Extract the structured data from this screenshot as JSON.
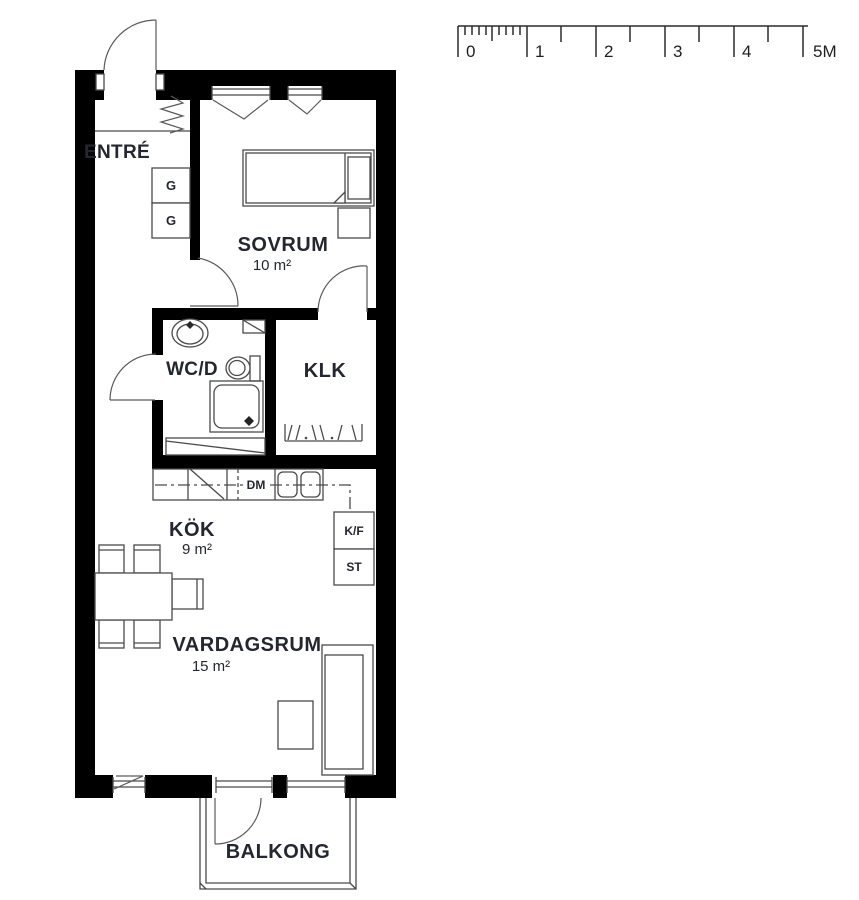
{
  "scale_bar": {
    "labels": [
      "0",
      "1",
      "2",
      "3",
      "4",
      "5M"
    ]
  },
  "rooms": {
    "entre": {
      "label": "ENTRÉ"
    },
    "sovrum": {
      "label": "SOVRUM",
      "area": "10 m²"
    },
    "wcd": {
      "label": "WC/D"
    },
    "klk": {
      "label": "KLK"
    },
    "kok": {
      "label": "KÖK",
      "area": "9 m²"
    },
    "vardagsrum": {
      "label": "VARDAGSRUM",
      "area": "15 m²"
    },
    "balkong": {
      "label": "BALKONG"
    }
  },
  "fixtures": {
    "wardrobe_top": "G",
    "wardrobe_bottom": "G",
    "dishwasher": "DM",
    "fridge_freezer": "K/F",
    "stove": "ST"
  },
  "colors": {
    "wall": "#000000",
    "line": "#4a4a4a",
    "text": "#23272f",
    "background": "#ffffff"
  }
}
